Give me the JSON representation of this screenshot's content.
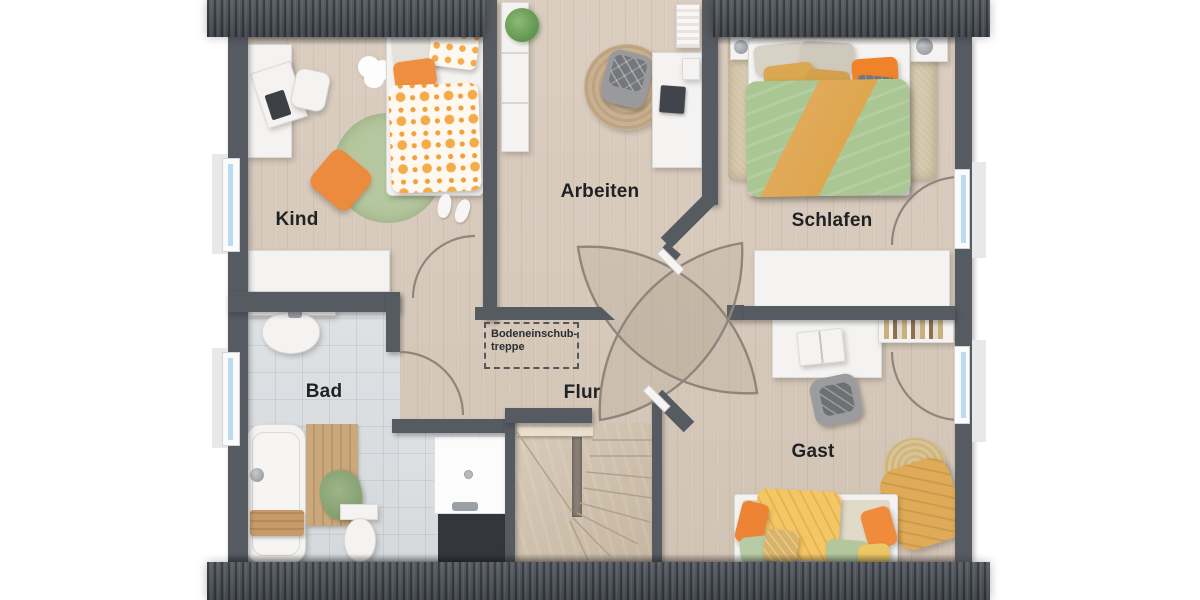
{
  "plan": {
    "type": "floorplan-top-view",
    "floor": "attic",
    "rooms": {
      "kind": {
        "label": "Kind"
      },
      "arbeiten": {
        "label": "Arbeiten"
      },
      "schlafen": {
        "label": "Schlafen"
      },
      "bad": {
        "label": "Bad"
      },
      "flur": {
        "label": "Flur"
      },
      "gast": {
        "label": "Gast"
      }
    },
    "annotation": {
      "line1": "Bodeneinschub-",
      "line2": "treppe"
    },
    "furniture": {
      "kind": [
        "desk",
        "desk-chair",
        "single-bed",
        "sage-round-rug",
        "cloud-rug",
        "floor-pillow",
        "slippers",
        "sideboard"
      ],
      "arbeiten": [
        "tall-shelf",
        "plant",
        "jute-round-rug",
        "office-chair",
        "desk",
        "laptop",
        "books"
      ],
      "schlafen": [
        "double-bed",
        "shag-rug",
        "nightstand-left",
        "nightstand-right",
        "lamps",
        "sideboard"
      ],
      "bad": [
        "washbasin-counter",
        "towel-rail",
        "bathtub",
        "bath-caddy",
        "wood-mat",
        "green-towel",
        "toilet",
        "shower"
      ],
      "flur": [
        "winder-staircase",
        "attic-hatch"
      ],
      "gast": [
        "desk",
        "open-book",
        "office-chair",
        "bookshelf",
        "round-rug",
        "mustard-throw",
        "daybed",
        "pillows"
      ]
    },
    "openings": [
      "kind-door",
      "bad-door",
      "central-pinwheel-doors",
      "schlafen-french-window",
      "gast-french-window",
      "left-window-kind",
      "left-window-bad"
    ],
    "colors": {
      "roof": "#4b5058",
      "wall": "#565a61",
      "wood_floor": "#d8cbbd",
      "tile_floor": "#dbdee1",
      "stair_wood": "#d3c5b3",
      "furniture_white": "#f4f3f1",
      "accent_orange": "#ed8a3c",
      "accent_green": "#aac492",
      "accent_mustard": "#dfab58",
      "accent_yellow": "#f4c664",
      "sage_rug": "#b5c79e",
      "window_glass": "#badbf0",
      "label_text": "#1f2124"
    }
  }
}
